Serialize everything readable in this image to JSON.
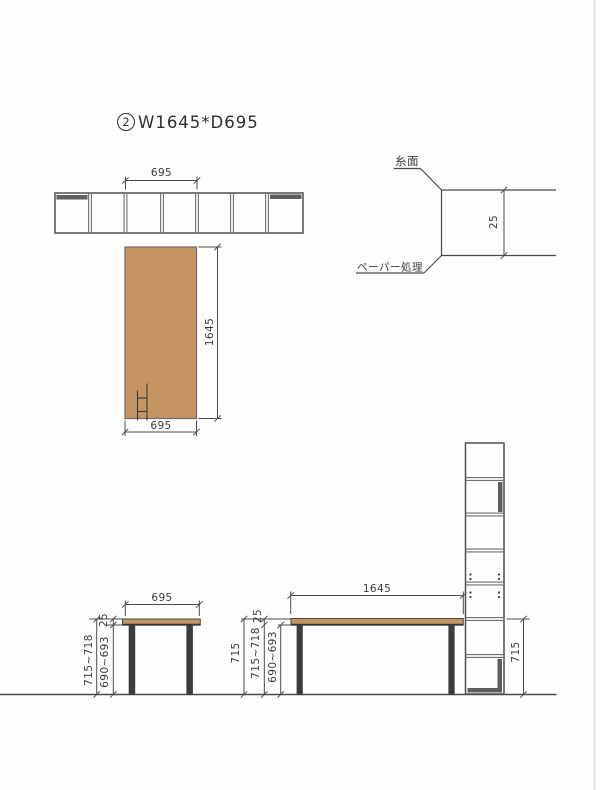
{
  "colors": {
    "tabletop_tan": "#c69462",
    "leg_dark": "#3c3c3e",
    "edge_strip": "#5e5e5e",
    "line": "#4b4b4b",
    "scan_edge": "#dde3e6"
  },
  "title": {
    "number": "2",
    "text": "W1645*D695"
  },
  "top_strip": {
    "width_dim": "695"
  },
  "plan_view": {
    "depth_dim": "695",
    "length_dim": "1645"
  },
  "edge_detail": {
    "top_label": "糸面",
    "bottom_label": "ペーパー処理",
    "thickness_dim": "25"
  },
  "left_elevation": {
    "width_dim": "695",
    "total_height_dim": "715~718",
    "underside_height_dim": "690~693",
    "top_thickness_dim": "25"
  },
  "right_elevation": {
    "width_dim": "1645",
    "height_dim": "715",
    "total_height_dim": "715~718",
    "underside_height_dim": "690~693",
    "top_thickness_dim": "25"
  },
  "stack_view": {
    "height_dim": "715"
  }
}
